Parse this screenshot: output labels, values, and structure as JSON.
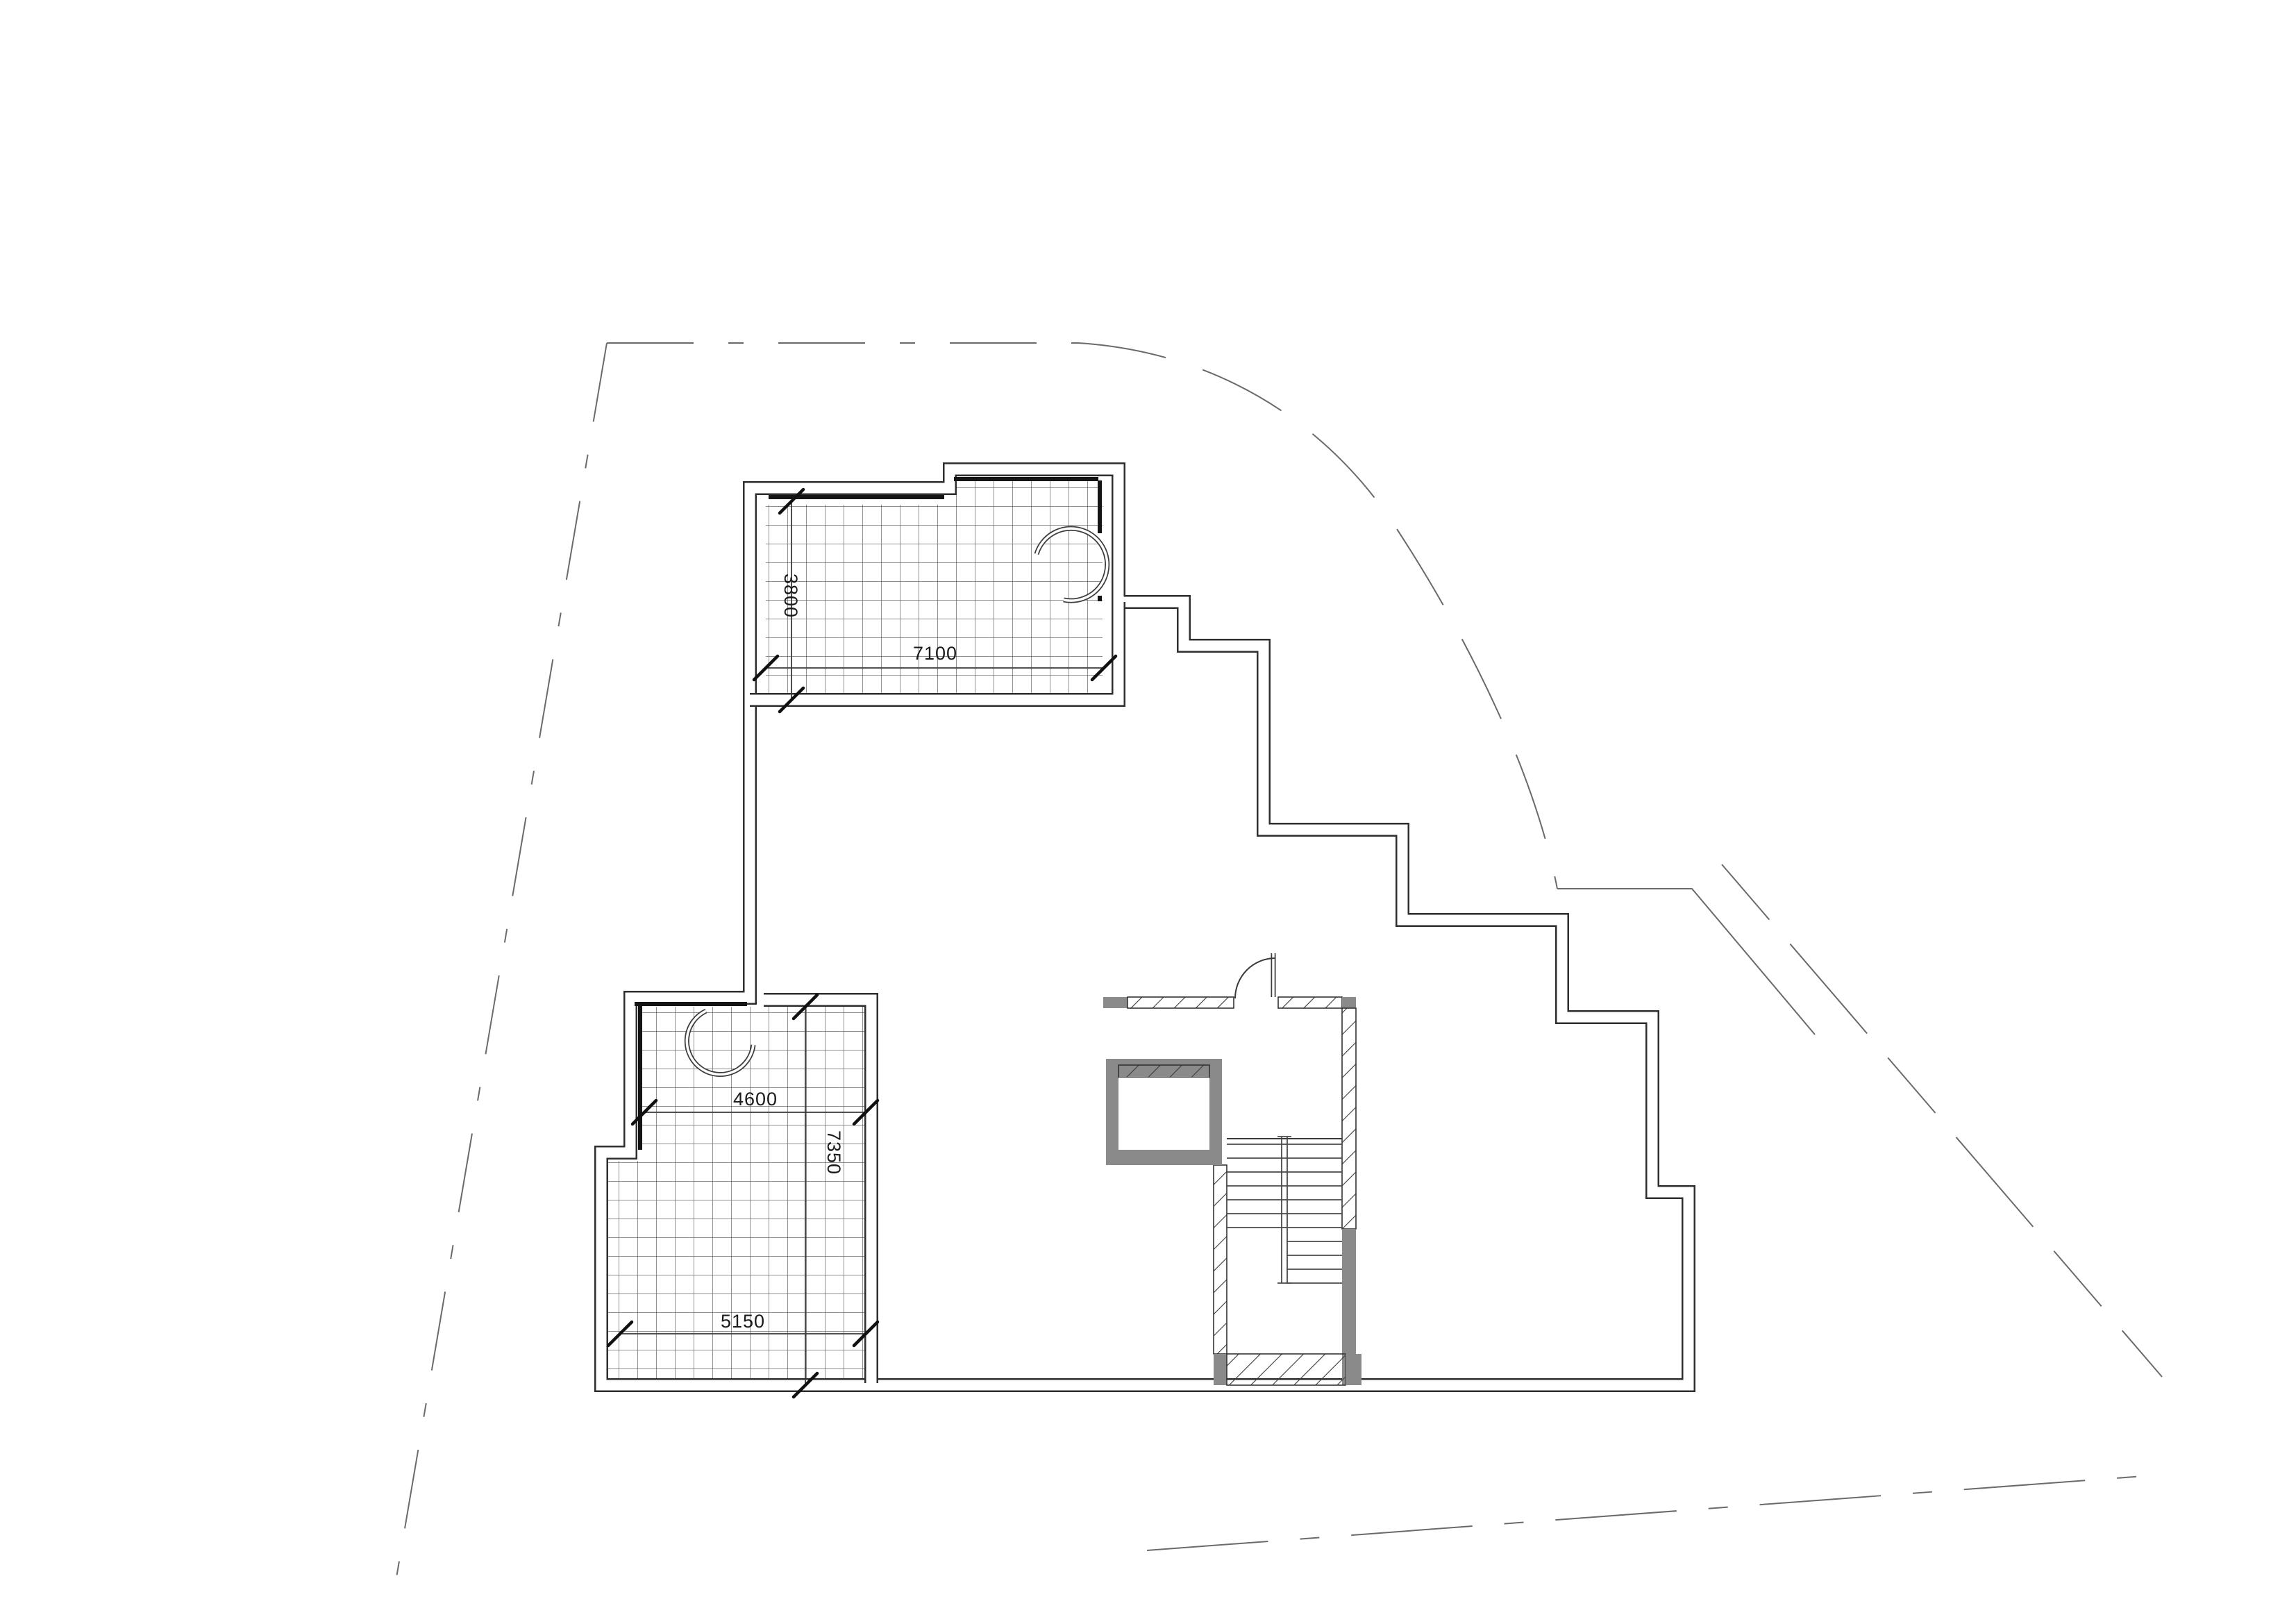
{
  "page": {
    "background": "#ffffff"
  },
  "plan": {
    "type": "architectural-floor-plan",
    "elements": {
      "upper_terrace": "tiled roof terrace with door swing",
      "lower_terrace": "tiled roof terrace with door swing",
      "stair_core": "U-shaped stair with central stringer",
      "elevator": "elevator shaft with hatched front wall",
      "entry_door": "door leaf with quarter-circle swing",
      "site_boundary": "dashed property boundary with curved corner"
    },
    "colors": {
      "line": "#3a3a3a",
      "wall_fill": "#8a8a8a",
      "hatch_line": "#3a3a3a",
      "background": "#ffffff"
    }
  },
  "dimensions": {
    "upper_terrace_depth": "3800",
    "upper_terrace_width": "7100",
    "lower_terrace_width_top": "4600",
    "lower_terrace_depth": "7350",
    "lower_terrace_width_bottom": "5150"
  }
}
